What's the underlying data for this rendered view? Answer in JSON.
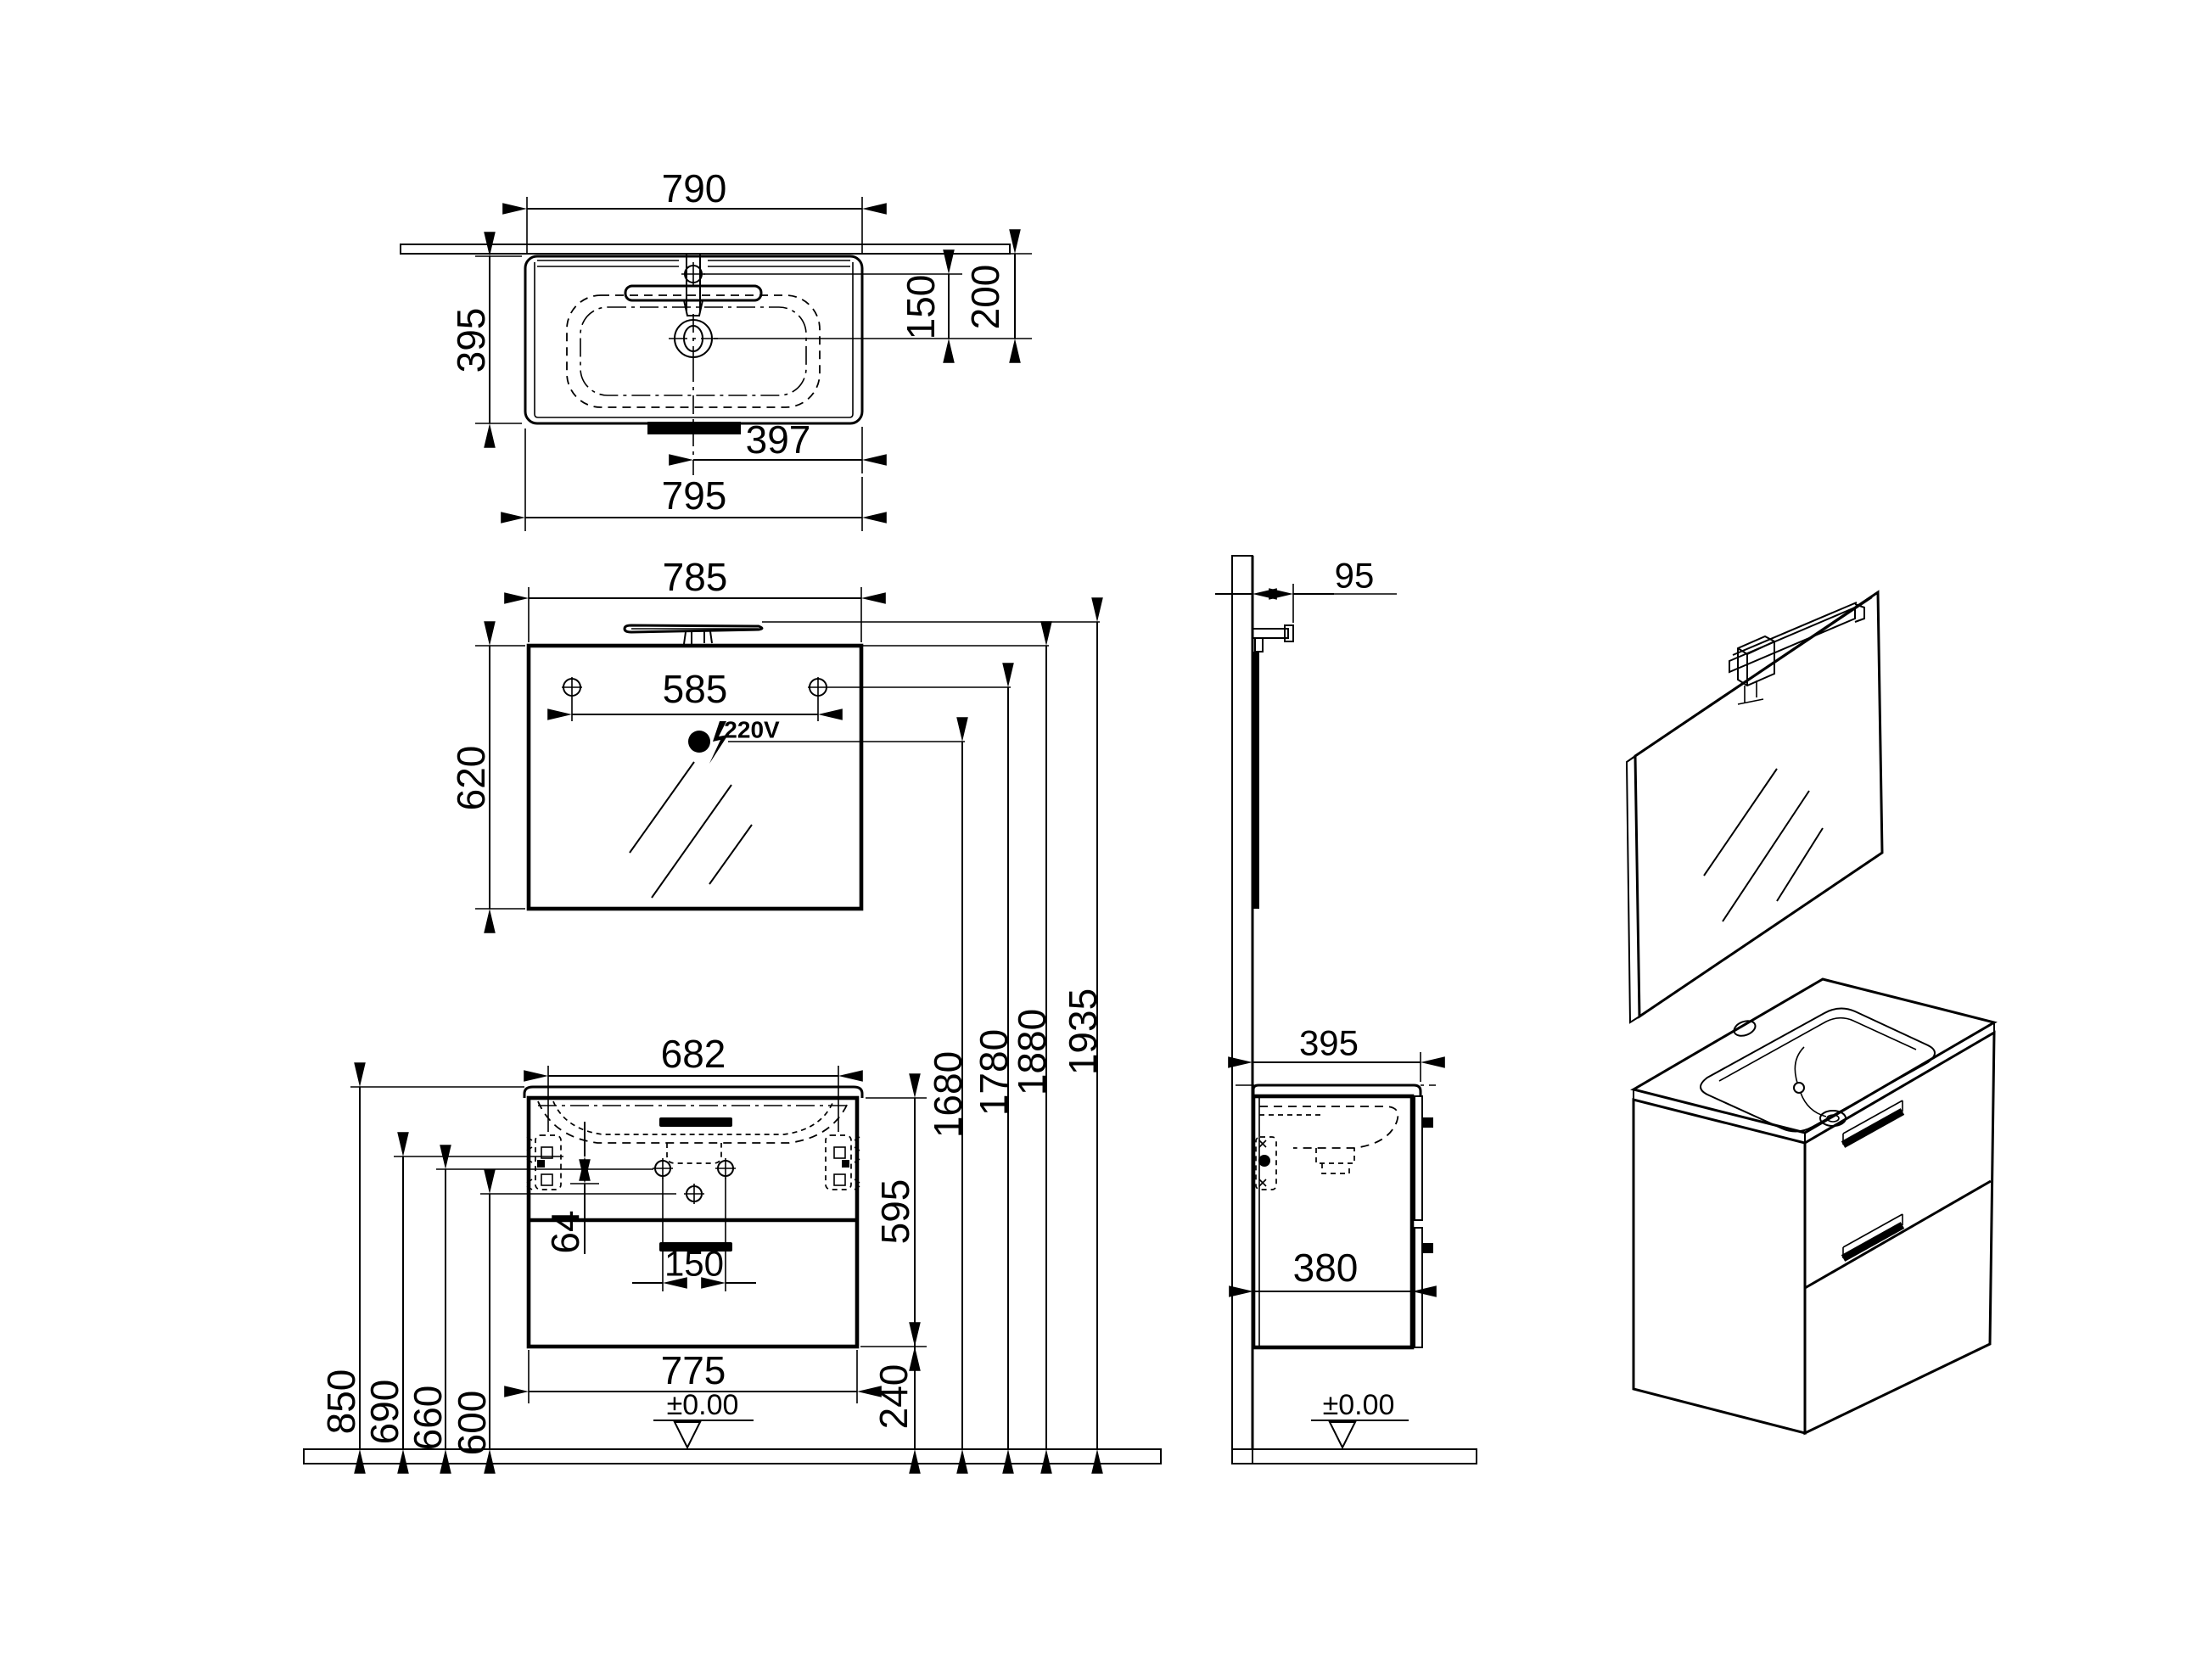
{
  "drawing": {
    "units": "mm",
    "top_view": {
      "width_top": "790",
      "depth": "395",
      "faucet_to_drain": "150",
      "wall_to_drain": "200",
      "drain_to_edge": "397",
      "total_width": "795"
    },
    "mirror_view": {
      "width": "785",
      "screw_spacing": "585",
      "height": "620",
      "power": "220V"
    },
    "install_heights": {
      "outlet_height": "1680",
      "screw_height": "1780",
      "mirror_top_height": "1880",
      "lamp_top_height": "1935"
    },
    "cabinet_view": {
      "bracket_spacing": "682",
      "body_height": "595",
      "bracket_screw_gap": "64",
      "handle_width": "150",
      "body_width": "775",
      "floor_clearance": "240",
      "worktop_height": "850",
      "bracket_height": "690",
      "handle_holes_height": "660",
      "lower_hole_height": "600",
      "floor_datum": "±0.00"
    },
    "side_view": {
      "lamp_depth": "95",
      "total_depth": "395",
      "body_depth": "380",
      "floor_datum": "±0.00"
    }
  }
}
